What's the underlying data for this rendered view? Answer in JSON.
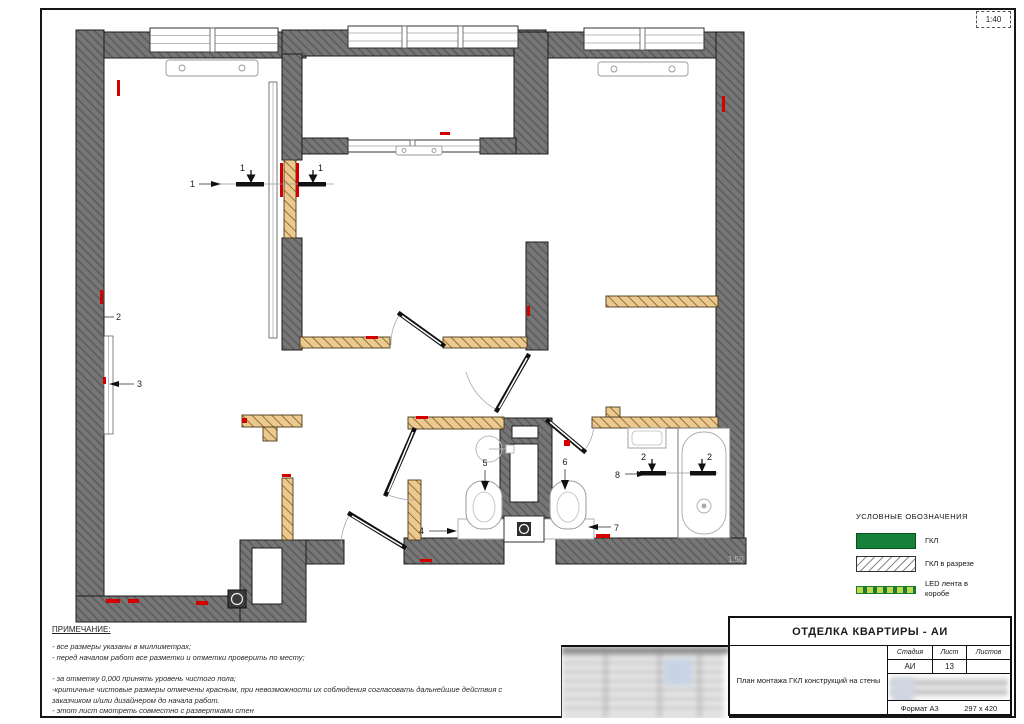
{
  "sheet": {
    "scale": "1:40",
    "plan_scale_note": "1:50"
  },
  "legend": {
    "title": "УСЛОВНЫЕ ОБОЗНАЧЕНИЯ",
    "items": [
      {
        "label": "ГКЛ",
        "swatch": "gkl-solid-green"
      },
      {
        "label": "ГКЛ в разрезе",
        "swatch": "gkl-section-hatch"
      },
      {
        "label": "LED лента в коробе",
        "swatch": "led-strip-dashed"
      }
    ]
  },
  "notes": {
    "title": "ПРИМЕЧАНИЕ:",
    "lines": [
      "- все размеры указаны в миллиметрах;",
      "- перед началом работ все разметки и отметки проверить по месту;",
      "",
      "- за отметку 0,000 принять уровень чистого пола;",
      "-критичные чистовые размеры отмечены красным, при невозможности их соблюдения согласовать дальнейшие действия с заказчиком и/или дизайнером до начала работ.",
      "- этот лист смотреть совместно с развертками стен"
    ]
  },
  "title_block": {
    "project_title": "ОТДЕЛКА КВАРТИРЫ - АИ",
    "drawing_title": "План монтажа ГКЛ конструкций на стены",
    "stage_label": "Стадия",
    "stage_value": "АИ",
    "sheet_label": "Лист",
    "sheet_value": "13",
    "sheets_label": "Листов",
    "sheets_value": "",
    "format_label": "Формат А3",
    "format_value": "297 x 420"
  },
  "plan": {
    "markers": {
      "view_1": "1",
      "section_1_left": "1",
      "section_1_right": "1",
      "elev_2": "2",
      "elev_3": "3",
      "elev_4": "4",
      "elev_5": "5",
      "elev_6": "6",
      "elev_7": "7",
      "elev_8": "8",
      "section_2_left": "2",
      "section_2_right": "2"
    }
  },
  "colors": {
    "wall_gray": "#767676",
    "gkl_partition_tan": "#ebca92",
    "gkl_green": "#17813a",
    "led_dash_green": "#bcdc4e",
    "critical_red": "#d40000",
    "frame_black": "#161616"
  }
}
